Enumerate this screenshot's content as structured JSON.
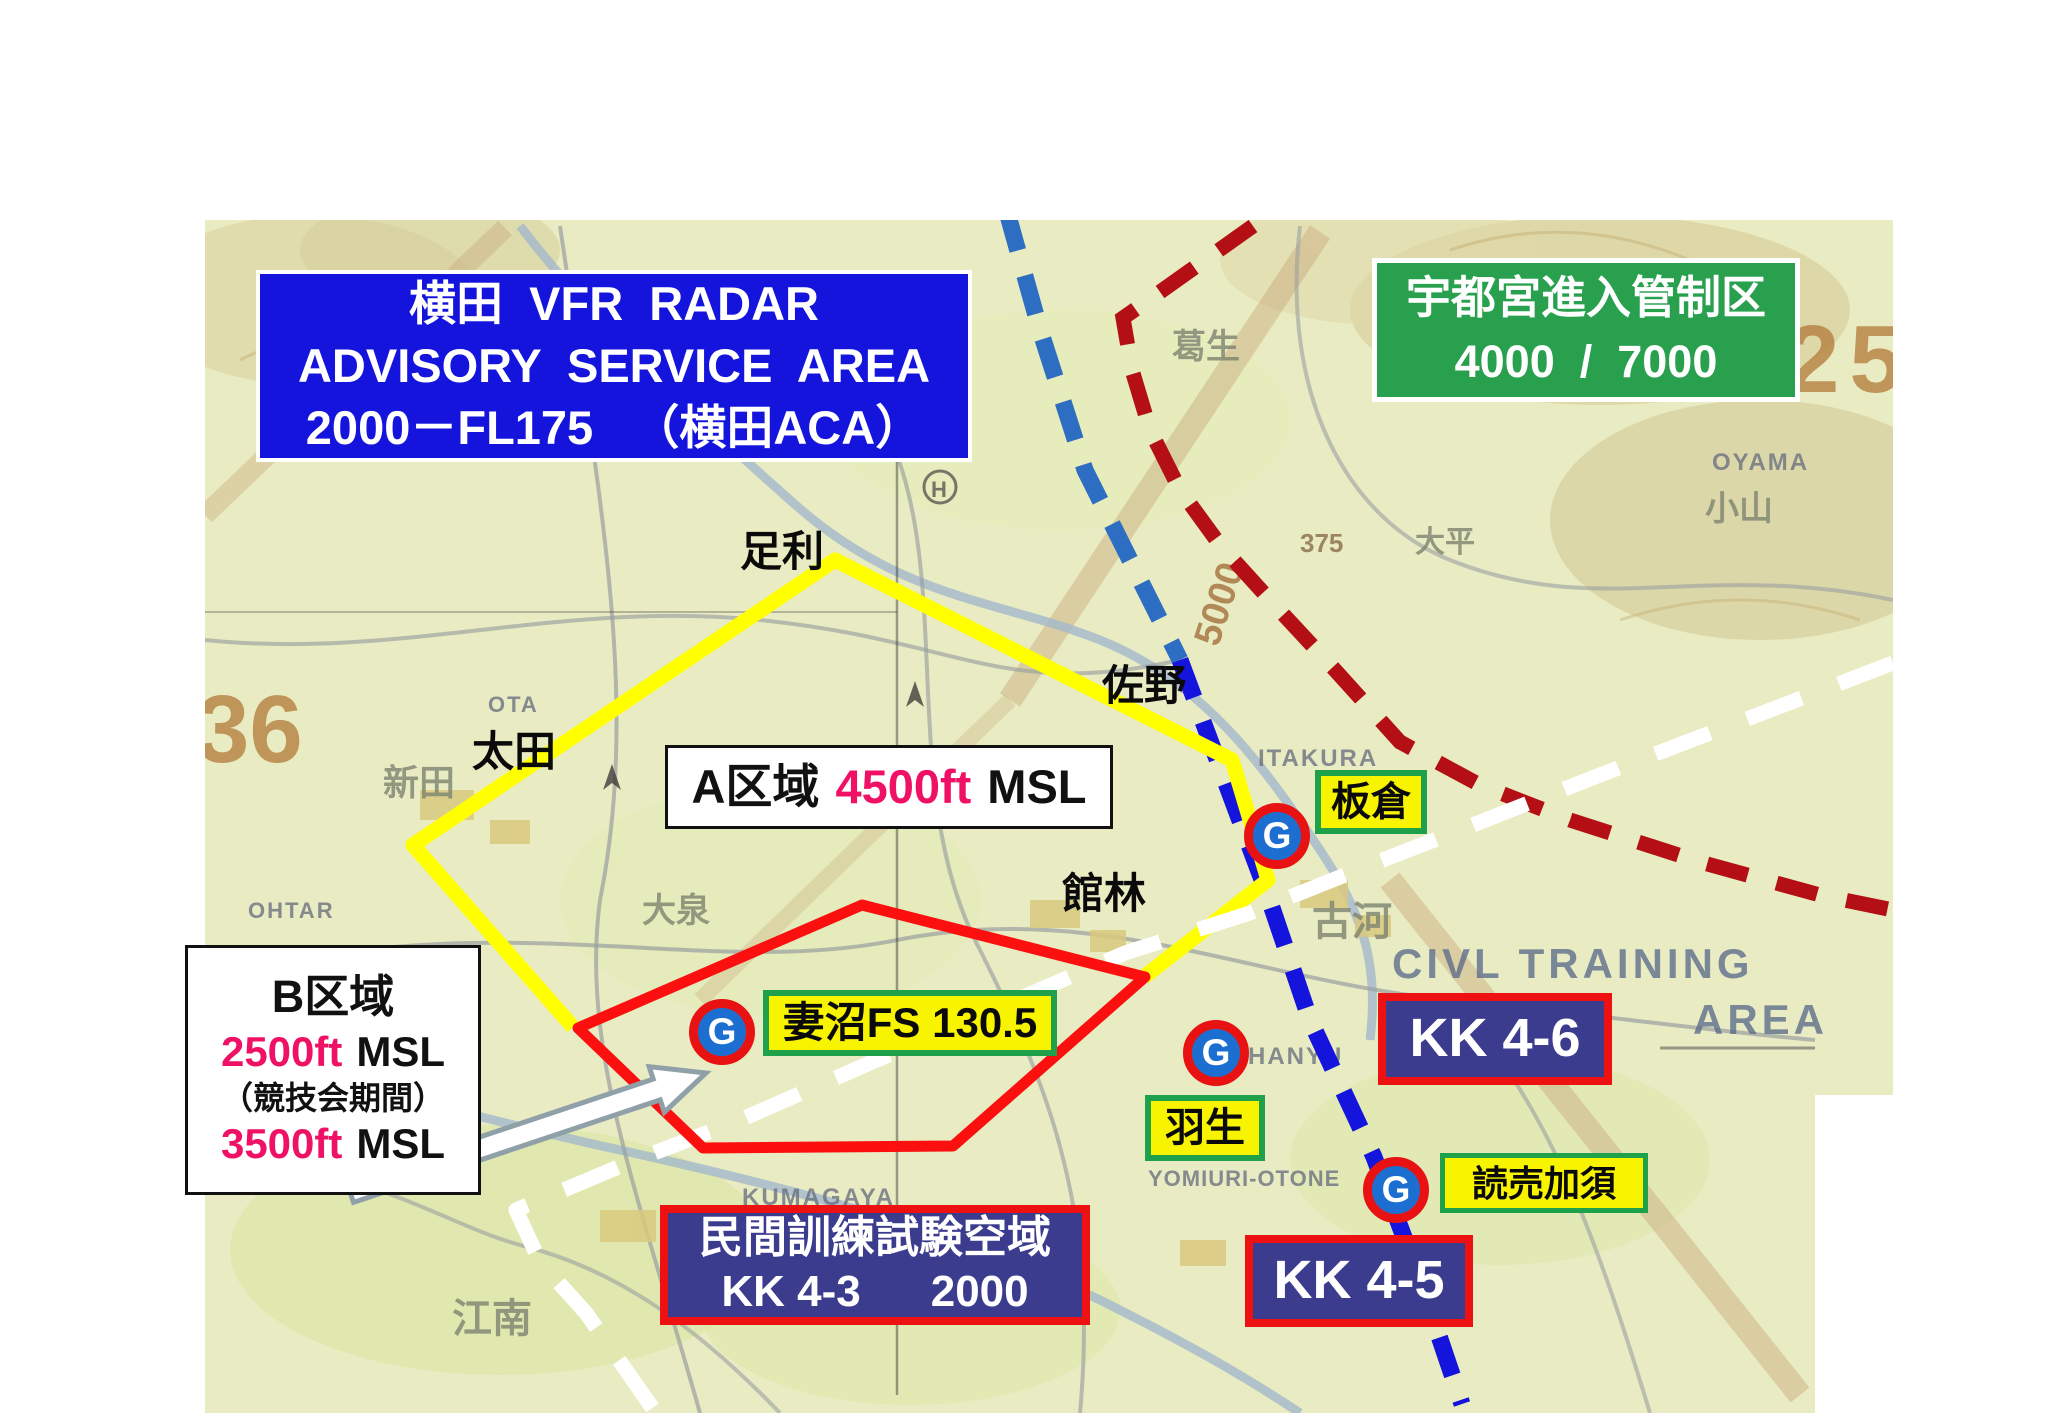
{
  "title_box": {
    "line1": "横田  VFR  RADAR",
    "line2": "ADVISORY  SERVICE  AREA",
    "line3": "2000－FL175   （横田ACA）"
  },
  "utsunomiya_box": {
    "line1": "宇都宮進入管制区",
    "line2": "4000  /  7000"
  },
  "area_a": {
    "name": "A区域",
    "altitude": "4500ft",
    "unit": "MSL"
  },
  "area_b": {
    "name": "B区域",
    "alt1": "2500ft",
    "unit1": "MSL",
    "note": "（競技会期間）",
    "alt2": "3500ft",
    "unit2": "MSL"
  },
  "menuma_label": "妻沼FS 130.5",
  "g_letter": "G",
  "waypoints": {
    "itakura": "板倉",
    "hanyu": "羽生",
    "yomiuri_kazo": "読売加須"
  },
  "cities": {
    "ashikaga": "足利",
    "sano": "佐野",
    "ota": "太田",
    "tatebayashi": "館林"
  },
  "kk": {
    "kk46": "KK 4-6",
    "kk45": "KK 4-5",
    "kk43_title": "民間訓練試験空域",
    "kk43_code": "KK 4-3",
    "kk43_alt": "2000"
  },
  "map_text": {
    "civl1": "CIVL TRAINING",
    "civl2": "AREA",
    "grid36": "36",
    "grid25": "25",
    "alt5000": "5000",
    "spot375": "375",
    "ashikaga_en": "ASHIKAGA",
    "ota_en": "OTA",
    "ohtar": "OHTAR",
    "oyama_en": "OYAMA",
    "oyama_jp": "小山",
    "ohira": "大平",
    "kuzuu": "葛生",
    "itakura_en": "ITAKURA",
    "hanyu_en": "HANYU",
    "yomiuri_en": "YOMIURI-OTONE",
    "kumagaya_en": "KUMAGAYA",
    "konan": "江南",
    "nitta": "新田",
    "oizumi": "大泉",
    "koga": "古河",
    "h_symbol": "H"
  },
  "colors": {
    "title_box_bg": "#1414dc",
    "utsunomiya_bg": "#28a04e",
    "kk_box_bg": "#3c3c8e",
    "kk_border": "#ee1111",
    "label_yellow": "#f8f400",
    "label_green_border": "#1fa04a",
    "altitude_pink": "#ef1166",
    "area_a_line": "#ffff00",
    "area_b_line": "#fb0f0f",
    "blue_dash_upper": "#2e6ec2",
    "blue_dash_lower": "#1414dc",
    "darkred_dash": "#b30f14",
    "white_dash": "#ffffff",
    "map_bg": "#e9ecc2"
  }
}
